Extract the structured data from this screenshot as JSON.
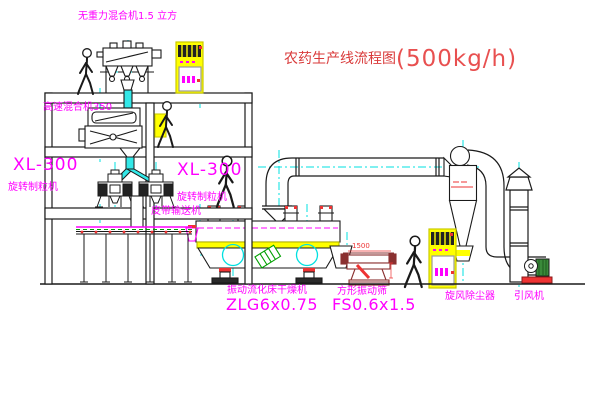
{
  "title": {
    "name": "农药生产线流程图",
    "capacity": "(500kg/h)"
  },
  "labels": {
    "gravity_mixer": "无重力混合机1.5 立方",
    "high_speed_mixer": "高速混合机350",
    "granulator_left_model": "XL-300",
    "granulator_left_name": "旋转制粒机",
    "granulator_mid_model": "XL-300",
    "granulator_mid_name": "旋转制粒机",
    "belt_conveyor": "皮带输送机",
    "fluid_bed_name": "振动流化床干燥机",
    "fluid_bed_model": "ZLG6x0.75",
    "screen_name": "方形振动筛",
    "screen_model": "FS0.6x1.5",
    "cyclone": "旋风除尘器",
    "fan": "引风机",
    "screen_dimension": "1500"
  },
  "colors": {
    "label_magenta": "#ff00ff",
    "title_red": "#d93a3a",
    "equipment_yellow": "#ffff00",
    "centerline_cyan": "#00e0e0",
    "pipe_cyan_fill": "#33e8e8",
    "accent_green": "#00a000",
    "accent_red": "#ee3333",
    "line_black": "#1a1a1a",
    "screen_maroon": "#8a3030"
  }
}
